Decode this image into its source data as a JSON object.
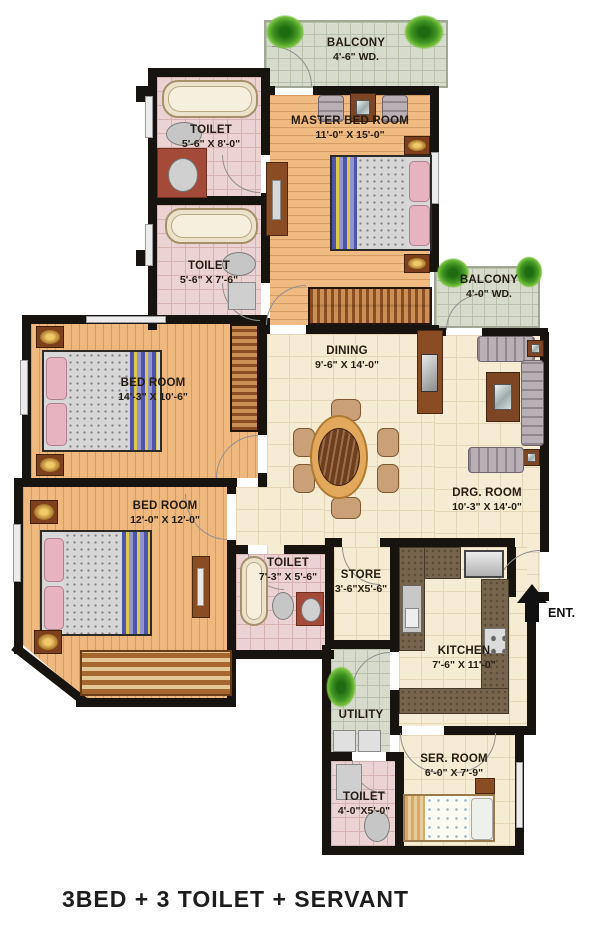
{
  "title": "3BED + 3 TOILET + SERVANT",
  "entrance_label": "ENT.",
  "rooms": {
    "balcony_top": {
      "name": "BALCONY",
      "dims": "4'-6\" WD."
    },
    "master_bedroom": {
      "name": "MASTER BED ROOM",
      "dims": "11'-0\" X 15'-0\""
    },
    "toilet_master": {
      "name": "TOILET",
      "dims": "5'-6\" X 8'-0\""
    },
    "toilet_mid": {
      "name": "TOILET",
      "dims": "5'-6\" X 7'-6\""
    },
    "balcony_right": {
      "name": "BALCONY",
      "dims": "4'-0\" WD."
    },
    "dining": {
      "name": "DINING",
      "dims": "9'-6\" X 14'-0\""
    },
    "drawing_room": {
      "name": "DRG. ROOM",
      "dims": "10'-3\" X 14'-0\""
    },
    "bedroom_mid": {
      "name": "BED ROOM",
      "dims": "14'-3\" X 10'-6\""
    },
    "bedroom_bottom": {
      "name": "BED ROOM",
      "dims": "12'-0\" X 12'-0\""
    },
    "toilet_common": {
      "name": "TOILET",
      "dims": "7'-3\" X 5'-6\""
    },
    "store": {
      "name": "STORE",
      "dims": "3'-6\"X5'-6\""
    },
    "kitchen": {
      "name": "KITCHEN",
      "dims": "7'-6\" X 11'-0\""
    },
    "utility": {
      "name": "UTILITY",
      "dims": ""
    },
    "servant_room": {
      "name": "SER. ROOM",
      "dims": "6'-0\" X 7'-9\""
    },
    "toilet_servant": {
      "name": "TOILET",
      "dims": "4'-0\"X5'-0\""
    }
  },
  "colors": {
    "wall": "#17130e",
    "wood_floor": "#f0bb82",
    "tile_floor": "#f6ecd4",
    "toilet_tile": "#ecd3d3",
    "balcony_tile": "#d7dbcc",
    "kitchen_counter": "#77644c",
    "plant_green": "#3f9422",
    "label_text": "#241c12"
  }
}
